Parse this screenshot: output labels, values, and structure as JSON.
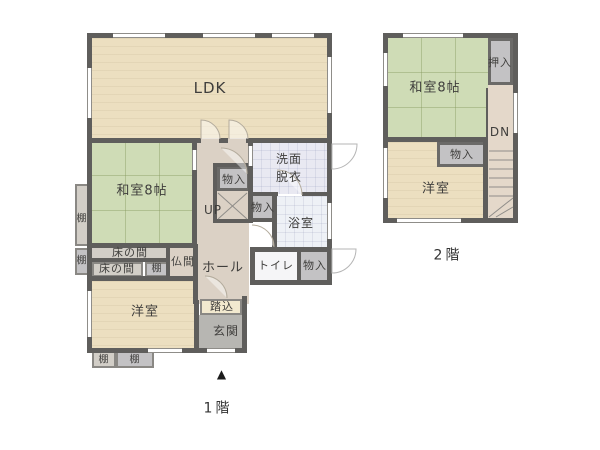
{
  "plan": {
    "type": "floor-plan",
    "colors": {
      "wall": "#5f5e5c",
      "wood_floor": "#ecdfc0",
      "tatami": "#cfdcb6",
      "hall": "#dbd1c5",
      "closet_gray": "#c3c2c4",
      "entry_gray": "#b7b6b2",
      "washroom": "#e9e9f2",
      "bathroom": "#eef1f6",
      "text": "#3f3e3c"
    },
    "floors": [
      {
        "name": "floor-1",
        "caption": "1階",
        "caption_pos": {
          "x": 218,
          "y": 409
        },
        "entrance_marker": "▲",
        "marker_pos": {
          "x": 222,
          "y": 374
        },
        "rooms": [
          {
            "name": "ldk",
            "label": "LDK",
            "x": 92,
            "y": 38,
            "w": 235,
            "h": 101,
            "style": "beige",
            "lx": 210,
            "ly": 88,
            "fs": 15,
            "top": false,
            "bd": 0
          },
          {
            "name": "washitsu-8jo",
            "label": "和室8帖",
            "x": 92,
            "y": 141,
            "w": 101,
            "h": 105,
            "style": "tatami",
            "lx": 142,
            "ly": 191,
            "fs": 13,
            "top": false,
            "bd": 0
          },
          {
            "name": "hall",
            "label": "ホール",
            "x": 197,
            "y": 138,
            "w": 52,
            "h": 166,
            "style": "hall",
            "lx": 223,
            "ly": 268,
            "fs": 13,
            "top": false,
            "bd": 0
          },
          {
            "name": "yoshitsu-1f",
            "label": "洋室",
            "x": 92,
            "y": 281,
            "w": 103,
            "h": 68,
            "style": "beige",
            "lx": 145,
            "ly": 312,
            "fs": 13,
            "top": false,
            "bd": 0
          },
          {
            "name": "senmen-datsui",
            "label": "洗面\n脱衣",
            "x": 252,
            "y": 141,
            "w": 75,
            "h": 53,
            "style": "wash",
            "lx": 289,
            "ly": 168,
            "fs": 12,
            "top": false,
            "bd": 0
          },
          {
            "name": "yokushitsu",
            "label": "浴室",
            "x": 276,
            "y": 196,
            "w": 51,
            "h": 51,
            "style": "bath",
            "lx": 301,
            "ly": 223,
            "fs": 12,
            "top": false,
            "bd": 0
          },
          {
            "name": "toilet",
            "label": "トイレ",
            "x": 254,
            "y": 252,
            "w": 43,
            "h": 29,
            "style": "white",
            "lx": 276,
            "ly": 266,
            "fs": 11,
            "top": false,
            "bd": 0
          },
          {
            "name": "monoire-toilet",
            "label": "物入",
            "x": 301,
            "y": 252,
            "w": 27,
            "h": 29,
            "style": "gray",
            "lx": 315,
            "ly": 266,
            "fs": 11,
            "top": false,
            "bd": 0
          },
          {
            "name": "stairs-up-area",
            "label": "",
            "x": 217,
            "y": 191,
            "w": 33,
            "h": 30,
            "style": "hall",
            "lx": 0,
            "ly": 0,
            "fs": 0,
            "top": true,
            "bd": 0
          },
          {
            "name": "monoire-stairs",
            "label": "物入",
            "x": 217,
            "y": 166,
            "w": 33,
            "h": 25,
            "style": "gray",
            "lx": 234,
            "ly": 180,
            "fs": 11,
            "top": true,
            "bd": 2
          },
          {
            "name": "monoire-hall",
            "label": "物入",
            "x": 252,
            "y": 196,
            "w": 24,
            "h": 24,
            "style": "gray",
            "lx": 263,
            "ly": 208,
            "fs": 11,
            "top": true,
            "bd": 0
          },
          {
            "name": "butsuma",
            "label": "仏間",
            "x": 170,
            "y": 246,
            "w": 27,
            "h": 32,
            "style": "hall",
            "lx": 183,
            "ly": 262,
            "fs": 11,
            "top": true,
            "bd": 0
          },
          {
            "name": "tokonoma-1",
            "label": "床の間",
            "x": 90,
            "y": 246,
            "w": 80,
            "h": 14,
            "style": "lightgray",
            "lx": 130,
            "ly": 253,
            "fs": 11,
            "top": true,
            "bd": 1
          },
          {
            "name": "tokonoma-2",
            "label": "床の間",
            "x": 92,
            "y": 262,
            "w": 51,
            "h": 15,
            "style": "lightgray",
            "lx": 117,
            "ly": 269,
            "fs": 11,
            "top": true,
            "bd": 1
          },
          {
            "name": "tana-mid",
            "label": "棚",
            "x": 145,
            "y": 262,
            "w": 25,
            "h": 15,
            "style": "gray",
            "lx": 157,
            "ly": 269,
            "fs": 10,
            "top": true,
            "bd": 1
          },
          {
            "name": "tana-left-1",
            "label": "棚",
            "x": 75,
            "y": 184,
            "w": 15,
            "h": 62,
            "style": "lightgray",
            "lx": 82,
            "ly": 219,
            "fs": 10,
            "top": true,
            "bd": 1
          },
          {
            "name": "tana-left-2",
            "label": "棚",
            "x": 75,
            "y": 248,
            "w": 14,
            "h": 27,
            "style": "gray",
            "lx": 82,
            "ly": 261,
            "fs": 10,
            "top": true,
            "bd": 1
          },
          {
            "name": "tana-bottom-1",
            "label": "棚",
            "x": 92,
            "y": 351,
            "w": 24,
            "h": 17,
            "style": "lightgray",
            "lx": 104,
            "ly": 360,
            "fs": 10,
            "top": true,
            "bd": 1
          },
          {
            "name": "tana-bottom-2",
            "label": "棚",
            "x": 116,
            "y": 351,
            "w": 38,
            "h": 17,
            "style": "gray",
            "lx": 135,
            "ly": 360,
            "fs": 10,
            "top": true,
            "bd": 1
          },
          {
            "name": "fumikomi",
            "label": "踏込",
            "x": 200,
            "y": 299,
            "w": 42,
            "h": 16,
            "style": "cream",
            "lx": 222,
            "ly": 307,
            "fs": 11,
            "top": true,
            "bd": 1
          },
          {
            "name": "genkan",
            "label": "玄関",
            "x": 198,
            "y": 315,
            "w": 46,
            "h": 36,
            "style": "genkan",
            "lx": 226,
            "ly": 331,
            "fs": 12,
            "top": true,
            "bd": 0
          }
        ],
        "labels": [
          {
            "name": "stairs-up-label",
            "text": "UP",
            "x": 213,
            "y": 210,
            "fs": 12
          }
        ],
        "walls": [
          [
            87,
            33,
            245,
            5
          ],
          [
            87,
            33,
            5,
            320
          ],
          [
            327,
            33,
            5,
            219
          ],
          [
            87,
            138,
            114,
            5
          ],
          [
            246,
            138,
            86,
            5
          ],
          [
            219,
            138,
            9,
            5
          ],
          [
            192,
            141,
            5,
            105
          ],
          [
            87,
            243,
            110,
            5
          ],
          [
            88,
            258,
            82,
            4
          ],
          [
            87,
            276,
            111,
            5
          ],
          [
            166,
            246,
            4,
            32
          ],
          [
            193,
            244,
            5,
            60
          ],
          [
            248,
            138,
            5,
            85
          ],
          [
            252,
            192,
            26,
            4
          ],
          [
            302,
            192,
            25,
            4
          ],
          [
            272,
            192,
            5,
            55
          ],
          [
            248,
            218,
            29,
            4
          ],
          [
            250,
            247,
            82,
            5
          ],
          [
            250,
            247,
            5,
            38
          ],
          [
            297,
            252,
            4,
            28
          ],
          [
            250,
            280,
            82,
            5
          ],
          [
            327,
            247,
            5,
            38
          ],
          [
            213,
            163,
            4,
            58
          ],
          [
            213,
            163,
            37,
            4
          ],
          [
            213,
            219,
            37,
            4
          ],
          [
            194,
            300,
            5,
            53
          ],
          [
            242,
            296,
            5,
            57
          ],
          [
            87,
            348,
            110,
            5
          ],
          [
            195,
            348,
            49,
            5
          ]
        ],
        "windows": [
          {
            "r": [
              113,
              33,
              52,
              5
            ],
            "o": "h"
          },
          {
            "r": [
              203,
              33,
              52,
              5
            ],
            "o": "h"
          },
          {
            "r": [
              272,
              33,
              42,
              5
            ],
            "o": "h"
          },
          {
            "r": [
              87,
              68,
              5,
              50
            ],
            "o": "v"
          },
          {
            "r": [
              327,
              57,
              5,
              56
            ],
            "o": "v"
          },
          {
            "r": [
              327,
              203,
              5,
              36
            ],
            "o": "v"
          },
          {
            "r": [
              87,
              291,
              5,
              46
            ],
            "o": "v"
          },
          {
            "r": [
              148,
              348,
              34,
              5
            ],
            "o": "h"
          },
          {
            "r": [
              207,
              348,
              28,
              5
            ],
            "o": "h"
          },
          {
            "r": [
              192,
              150,
              5,
              20
            ],
            "o": "v"
          },
          {
            "r": [
              248,
              146,
              5,
              20
            ],
            "o": "v"
          }
        ],
        "stair_lines": [
          [
            218,
            193,
            247,
            219
          ],
          [
            247,
            193,
            218,
            219
          ]
        ],
        "door_arcs": [
          "M201,139 V120 A19,19 0 0 1 220,139",
          "M229,139 V120 A19,19 0 0 1 248,139",
          "M221,148 A26,26 0 0 1 247,174",
          "M277,170 A25,25 0 0 1 302,195",
          "M252,225 A22,22 0 0 1 274,247",
          "M205,276 A22,22 0 0 1 227,298"
        ],
        "exterior_door_bumps": [
          "M332,144 h25 a25,25 0 0 1 -25,25 z",
          "M332,249 h24 a24,24 0 0 1 -24,24 z"
        ]
      },
      {
        "name": "floor-2",
        "caption": "2階",
        "caption_pos": {
          "x": 448,
          "y": 256
        },
        "entrance_marker": "",
        "marker_pos": {
          "x": 0,
          "y": 0
        },
        "rooms": [
          {
            "name": "washitsu-8jo-2f",
            "label": "和室8帖",
            "x": 388,
            "y": 38,
            "w": 100,
            "h": 101,
            "style": "tatami",
            "lx": 435,
            "ly": 88,
            "fs": 13,
            "top": false,
            "bd": 0
          },
          {
            "name": "yoshitsu-2f",
            "label": "洋室",
            "x": 388,
            "y": 142,
            "w": 100,
            "h": 76,
            "style": "beige",
            "lx": 436,
            "ly": 189,
            "fs": 13,
            "top": false,
            "bd": 0
          },
          {
            "name": "corridor-2f",
            "label": "",
            "x": 488,
            "y": 85,
            "w": 25,
            "h": 57,
            "style": "corridor",
            "lx": 0,
            "ly": 0,
            "fs": 0,
            "top": false,
            "bd": 0
          },
          {
            "name": "stairs-down-area",
            "label": "",
            "x": 488,
            "y": 142,
            "w": 25,
            "h": 76,
            "style": "corridor",
            "lx": 0,
            "ly": 0,
            "fs": 0,
            "top": false,
            "bd": 0
          },
          {
            "name": "oshiire",
            "label": "押入",
            "x": 488,
            "y": 38,
            "w": 25,
            "h": 47,
            "style": "gray",
            "lx": 500,
            "ly": 63,
            "fs": 11,
            "top": true,
            "bd": 2
          },
          {
            "name": "monoire-2f",
            "label": "物入",
            "x": 437,
            "y": 142,
            "w": 51,
            "h": 25,
            "style": "gray",
            "lx": 462,
            "ly": 155,
            "fs": 11,
            "top": true,
            "bd": 2
          }
        ],
        "labels": [
          {
            "name": "stairs-down-label",
            "text": "DN",
            "x": 500,
            "y": 132,
            "fs": 12
          }
        ],
        "walls": [
          [
            383,
            33,
            135,
            5
          ],
          [
            383,
            33,
            5,
            190
          ],
          [
            513,
            33,
            5,
            190
          ],
          [
            383,
            218,
            135,
            5
          ],
          [
            383,
            137,
            105,
            5
          ],
          [
            483,
            137,
            5,
            86
          ],
          [
            486,
            88,
            2,
            49
          ]
        ],
        "windows": [
          {
            "r": [
              403,
              33,
              60,
              5
            ],
            "o": "h"
          },
          {
            "r": [
              383,
              53,
              5,
              33
            ],
            "o": "v"
          },
          {
            "r": [
              383,
              148,
              5,
              50
            ],
            "o": "v"
          },
          {
            "r": [
              397,
              218,
              64,
              5
            ],
            "o": "h"
          },
          {
            "r": [
              513,
              93,
              5,
              40
            ],
            "o": "v"
          }
        ],
        "stair_lines": [
          [
            489,
            151,
            513,
            151
          ],
          [
            489,
            160,
            513,
            160
          ],
          [
            489,
            169,
            513,
            169
          ],
          [
            489,
            178,
            513,
            178
          ],
          [
            489,
            187,
            513,
            187
          ],
          [
            489,
            196,
            513,
            196
          ],
          [
            489,
            217,
            513,
            198
          ],
          [
            496,
            217,
            513,
            207
          ]
        ],
        "door_arcs": [],
        "exterior_door_bumps": []
      }
    ]
  }
}
